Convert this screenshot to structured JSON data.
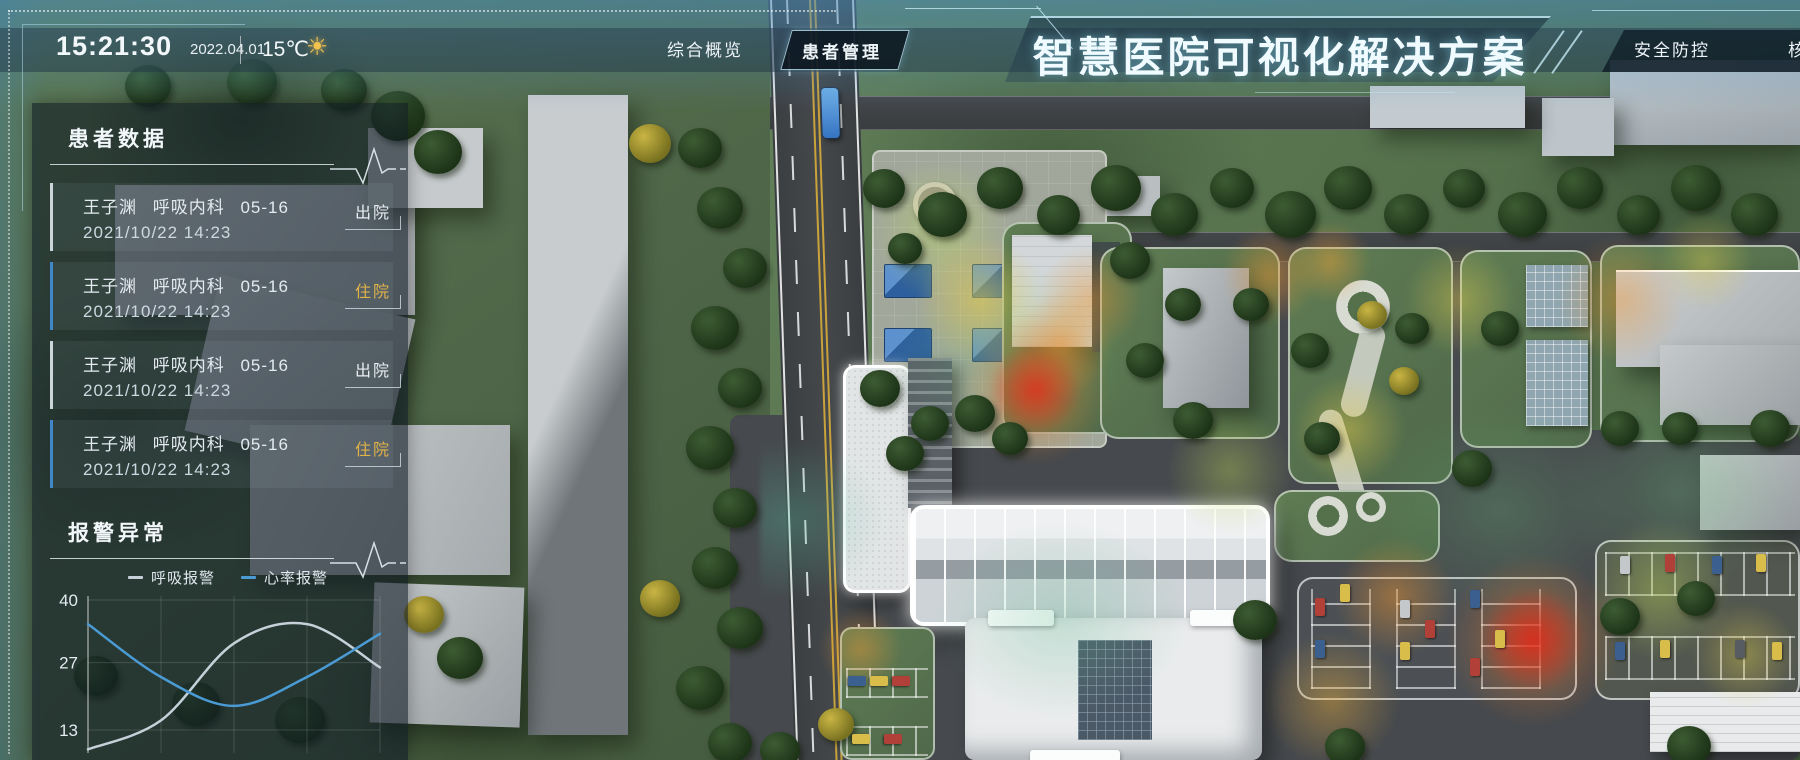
{
  "header": {
    "time": "15:21:30",
    "date": "2022.04.01",
    "temperature": "15℃",
    "weather_icon": "sun-icon",
    "title": "智慧医院可视化解决方案",
    "nav_left": [
      {
        "label": "综合概览"
      },
      {
        "label": "患者管理"
      }
    ],
    "active_tab": "患者管理",
    "nav_right": [
      {
        "label": "安全防控"
      },
      {
        "label": "核"
      }
    ]
  },
  "patient_panel": {
    "title": "患者数据",
    "items": [
      {
        "name": "王子渊",
        "department": "呼吸内科",
        "bed": "05-16",
        "datetime": "2021/10/22 14:23",
        "status": "出院"
      },
      {
        "name": "王子渊",
        "department": "呼吸内科",
        "bed": "05-16",
        "datetime": "2021/10/22 14:23",
        "status": "住院"
      },
      {
        "name": "王子渊",
        "department": "呼吸内科",
        "bed": "05-16",
        "datetime": "2021/10/22 14:23",
        "status": "出院"
      },
      {
        "name": "王子渊",
        "department": "呼吸内科",
        "bed": "05-16",
        "datetime": "2021/10/22 14:23",
        "status": "住院"
      }
    ],
    "status_colors": {
      "出院": "#e8eef3",
      "住院": "#e0b24a"
    }
  },
  "alarm_panel": {
    "title": "报警异常"
  },
  "chart_data": {
    "type": "line",
    "title": "报警异常",
    "x": [
      0,
      1,
      2,
      3,
      4
    ],
    "xticks_visible": false,
    "series": [
      {
        "name": "呼吸报警",
        "color": "#c5d0d9",
        "values": [
          9,
          15,
          31,
          35,
          26
        ]
      },
      {
        "name": "心率报警",
        "color": "#4a9ad4",
        "values": [
          35,
          24,
          18,
          24,
          33
        ]
      }
    ],
    "yticks": [
      40,
      27,
      13
    ],
    "ylim": [
      8,
      42
    ],
    "grid": true,
    "legend_position": "top"
  }
}
